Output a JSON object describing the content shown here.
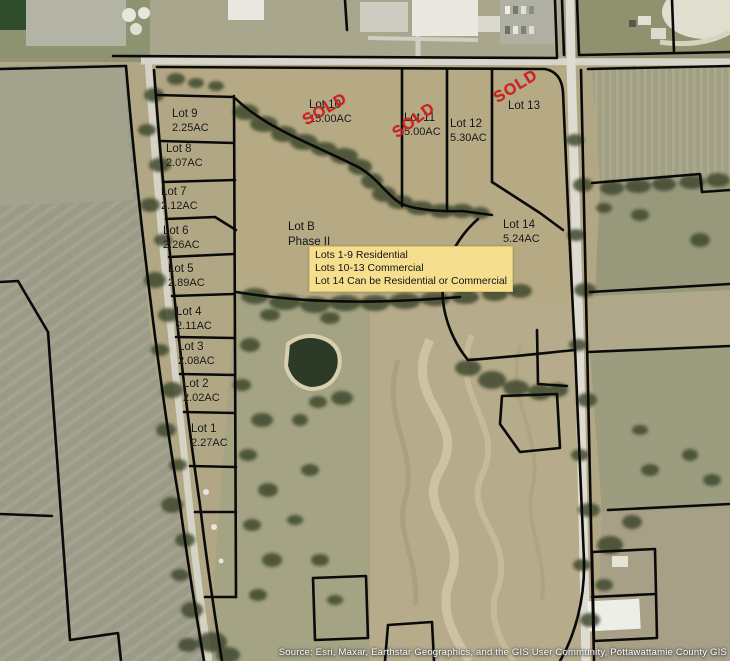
{
  "map": {
    "attribution": "Source: Esri, Maxar, Earthstar Geographics, and the GIS User Community, Pottawattamie County GIS",
    "sold_stamp_text": "SOLD",
    "phase_label": {
      "line1": "Lot B",
      "line2": "Phase II"
    },
    "legend": {
      "background_color": "#f5df8e",
      "lines": [
        "Lots 1-9 Residential",
        "Lots 10-13 Commercial",
        "Lot 14 Can be Residential or Commercial"
      ]
    },
    "lots": [
      {
        "label": "Lot 1",
        "acreage": "2.27AC",
        "sold": false
      },
      {
        "label": "Lot 2",
        "acreage": "2.02AC",
        "sold": false
      },
      {
        "label": "Lot 3",
        "acreage": "2.08AC",
        "sold": false
      },
      {
        "label": "Lot 4",
        "acreage": "2.11AC",
        "sold": false
      },
      {
        "label": "Lot 5",
        "acreage": "2.89AC",
        "sold": false
      },
      {
        "label": "Lot 6",
        "acreage": "2.26AC",
        "sold": false
      },
      {
        "label": "Lot 7",
        "acreage": "2.12AC",
        "sold": false
      },
      {
        "label": "Lot 8",
        "acreage": "2.07AC",
        "sold": false
      },
      {
        "label": "Lot 9",
        "acreage": "2.25AC",
        "sold": false
      },
      {
        "label": "Lot 10",
        "acreage": "15.00AC",
        "sold": true
      },
      {
        "label": "Lot 11",
        "acreage": "5.00AC",
        "sold": true
      },
      {
        "label": "Lot 12",
        "acreage": "5.30AC",
        "sold": false
      },
      {
        "label": "Lot 13",
        "acreage": "",
        "sold": true
      },
      {
        "label": "Lot 14",
        "acreage": "5.24AC",
        "sold": false
      }
    ],
    "colors": {
      "sold_red": "#cf2020",
      "boundary_black": "#000000",
      "road_gray": "#d8d6cb",
      "legend_yellow": "#f5df8e"
    }
  }
}
